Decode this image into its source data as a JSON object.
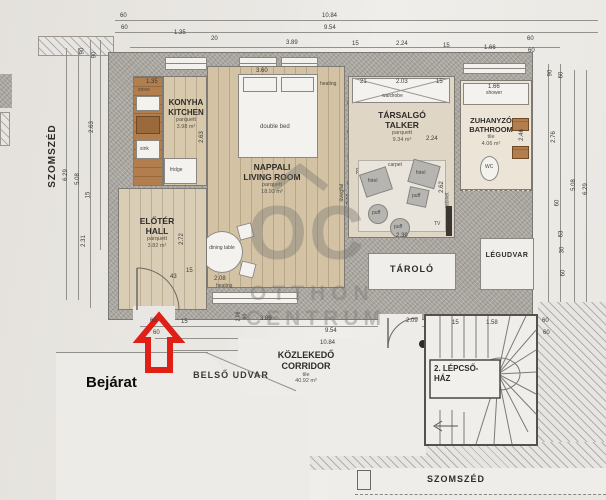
{
  "watermark": {
    "logo": "OC",
    "line1": "OTTHON",
    "line2": "CENTRUM"
  },
  "outside": {
    "neighbor_left": "SZOMSZÉD",
    "neighbor_bottom": "SZOMSZÉD",
    "inner_courtyard": "BELSŐ UDVAR",
    "entrance": "Bejárat",
    "light_well": "LÉGUDVAR",
    "storage": "TÁROLÓ"
  },
  "rooms": {
    "kitchen": {
      "hu": "KONYHA",
      "en": "KITCHEN",
      "floor": "parquett",
      "area": "3.98 m²"
    },
    "living": {
      "hu": "NAPPALI",
      "en": "LIVING ROOM",
      "floor": "parquett",
      "area": "18.93 m²"
    },
    "hall": {
      "hu": "ELŐTÉR",
      "en": "HALL",
      "floor": "parquett",
      "area": "3.82 m²"
    },
    "talker": {
      "hu": "TÁRSALGÓ",
      "en": "TALKER",
      "floor": "parquett",
      "area": "9.34 m²"
    },
    "bathroom": {
      "hu": "ZUHANYZÓ",
      "en": "BATHROOM",
      "floor": "tile",
      "area": "4.06 m²"
    },
    "corridor": {
      "hu": "KÖZLEKEDŐ",
      "en": "CORRIDOR",
      "floor": "tile",
      "area": "40.92 m²"
    },
    "staircase": {
      "line1": "2. LÉPCSŐ-",
      "line2": "HÁZ"
    }
  },
  "furniture": {
    "double_bed": "double bed",
    "dining_table": "dining table",
    "fridge": "fridge",
    "sink": "sink",
    "stove": "stove",
    "wardrobe": "wardrobe",
    "shower": "shower",
    "wc": "WC",
    "fotel": "fotel",
    "puff": "puff",
    "tv": "TV",
    "carpet": "carpet",
    "cabinet": "cabinet",
    "heating": "heating",
    "glass_wall": "üvegfal"
  },
  "dims": {
    "top": [
      "60",
      "60",
      "1.35",
      "20",
      "3.89",
      "10.84",
      "9.54",
      "15",
      "2.24",
      "15",
      "1.66",
      "60",
      "60"
    ],
    "left": [
      "90",
      "90",
      "2.63",
      "6.29",
      "5.08",
      "15",
      "2.31"
    ],
    "right": [
      "90",
      "60",
      "2.76",
      "60",
      "63",
      "30",
      "60",
      "5.08",
      "6.29"
    ],
    "bottom": [
      "60",
      "60",
      "15",
      "2.08",
      "90",
      "3.89",
      "9.54",
      "10.84",
      "2.09",
      "15",
      "1.58",
      "60",
      "60"
    ],
    "inner": [
      "1.35",
      "2.63",
      "3.60",
      "2.08",
      "2.72",
      "43",
      "15",
      "21",
      "2.03",
      "15",
      "2.62",
      "2.39",
      "70",
      "2.24",
      "1.66",
      "2.46",
      "2.11",
      "50",
      "15",
      "10",
      "70"
    ]
  }
}
